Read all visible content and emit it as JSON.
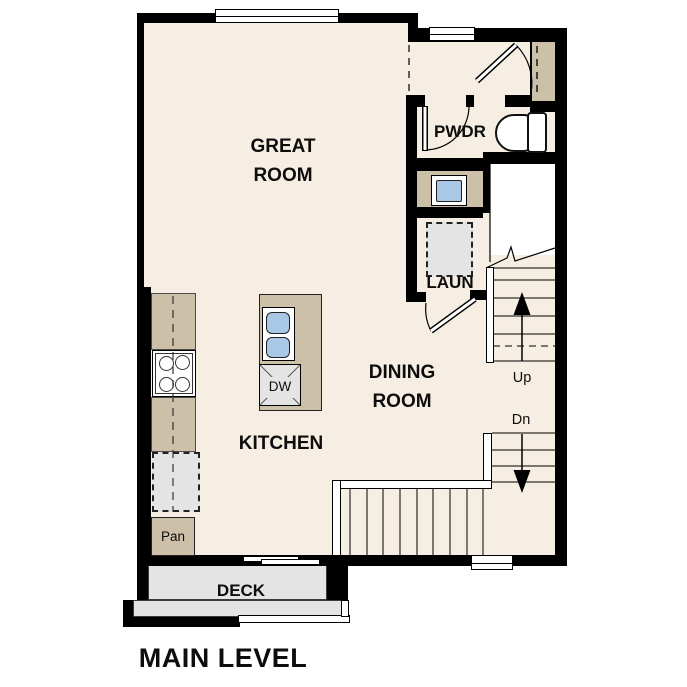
{
  "title": "MAIN LEVEL",
  "colors": {
    "wall": "#000000",
    "floor": "#f6eee2",
    "counter": "#cdc0a8",
    "appliance": "#e4e4e4",
    "fixture_blue": "#a9c8e6",
    "deck": "#e4e4e4",
    "bg": "#ffffff"
  },
  "rooms": {
    "great_room": {
      "label": "GREAT\nROOM"
    },
    "kitchen": {
      "label": "KITCHEN"
    },
    "dining_room": {
      "label": "DINING\nROOM"
    },
    "powder_room": {
      "label": "PWDR"
    },
    "laundry": {
      "label": "LAUN"
    },
    "pantry": {
      "label": "Pan"
    },
    "deck": {
      "label": "DECK"
    }
  },
  "fixtures": {
    "dishwasher": {
      "label": "DW"
    }
  },
  "stairs": {
    "up": {
      "label": "Up"
    },
    "down": {
      "label": "Dn"
    }
  }
}
